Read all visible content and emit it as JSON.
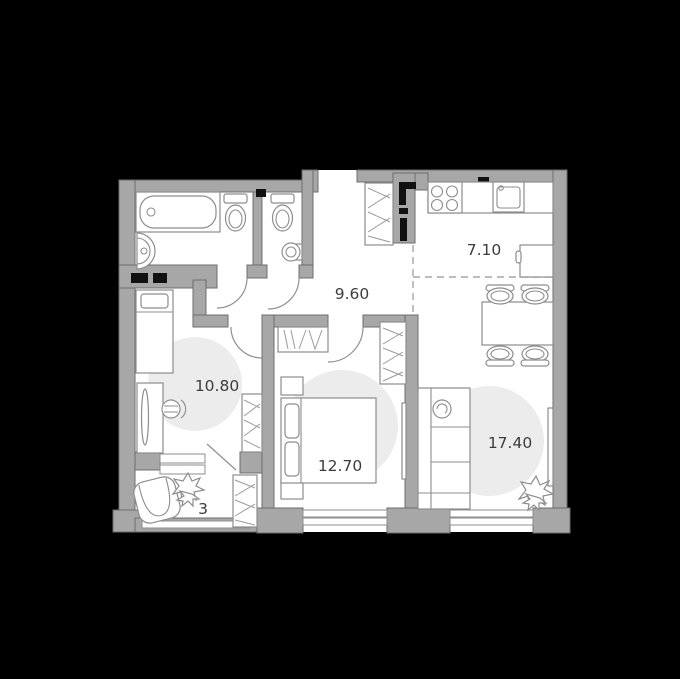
{
  "plan": {
    "type": "apartment-floor-plan",
    "background": "#000000"
  },
  "rooms": {
    "hallway": {
      "label": "9.60"
    },
    "kitchen": {
      "label": "7.10"
    },
    "bedroom_small": {
      "label": "10.80"
    },
    "bedroom_master": {
      "label": "12.70"
    },
    "living": {
      "label": "17.40"
    },
    "balcony": {
      "label": "3"
    }
  },
  "colors": {
    "background": "#000000",
    "wall": "#a7a7a7",
    "wall_outline": "#6d6d6d",
    "floor": "#ffffff",
    "rug": "#ececec",
    "furniture_stroke": "#8d8d8d",
    "label_text": "#3c3c3c",
    "zone_dash": "#a5a5a5",
    "shaft_mark": "#111111",
    "entrance_door": "#000000"
  },
  "icons": [
    "bathtub-icon",
    "washbasin-icon",
    "toilet-icon",
    "corner-sink-icon",
    "stove-icon",
    "kitchen-sink-icon",
    "fridge-icon",
    "wardrobe-icon",
    "vent-shaft-icon",
    "dining-table-icon",
    "stool-icon",
    "sofa-icon",
    "radiator-icon",
    "plant-icon",
    "armchair-icon",
    "single-bed-icon",
    "double-bed-icon",
    "desk-icon",
    "desk-chair-icon",
    "nightstand-icon",
    "window-icon",
    "door-arc-icon",
    "entrance-door-icon",
    "rug-icon"
  ]
}
